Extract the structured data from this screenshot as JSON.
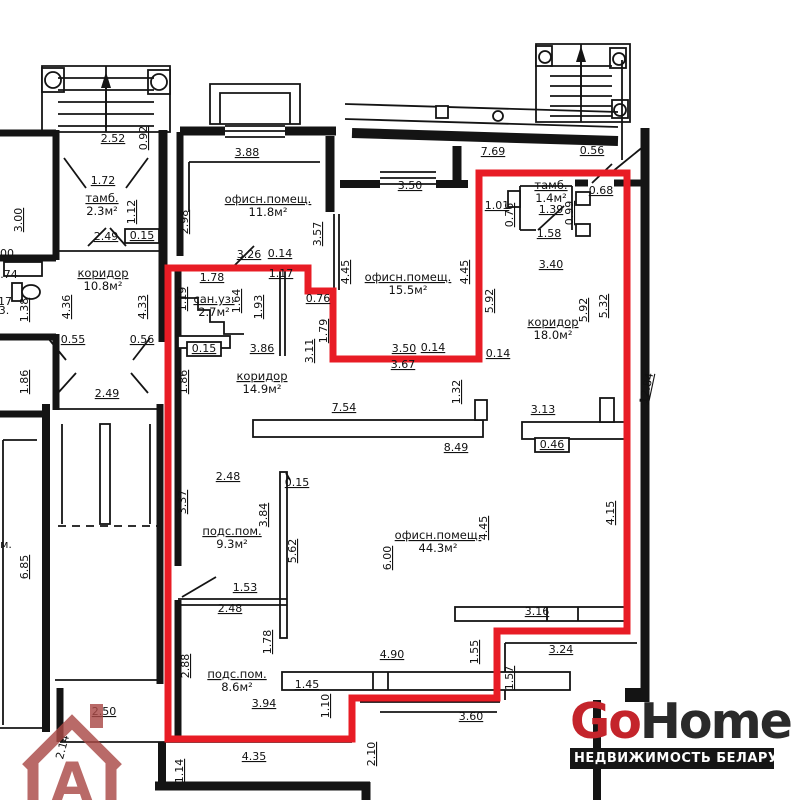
{
  "colors": {
    "outline_red": "#e81c25",
    "wall_black": "#141414",
    "watermark": "#aa4a47",
    "background": "#ffffff"
  },
  "branding": {
    "logo_go": "Go",
    "logo_home": "Home",
    "tagline": "НЕДВИЖИМОСТЬ БЕЛАРУСИ",
    "logo_red": "#c4242b",
    "logo_dark": "#2a2a2a",
    "watermark_letter": "A"
  },
  "plan": {
    "red_outline": "168,268 308,268 308,291 333,291 333,359 479,359 479,173 627,173 627,631 497,631 497,698 352,698 352,739 168,739",
    "rooms": [
      {
        "name": "тамб.",
        "area": "2.3м²",
        "x": 102,
        "y": 202
      },
      {
        "name": "офисн.помещ.",
        "area": "11.8м²",
        "x": 268,
        "y": 203
      },
      {
        "name": "коридор",
        "area": "10.8м²",
        "x": 103,
        "y": 277
      },
      {
        "name": "сан.уз.",
        "area": "2.7м²",
        "x": 214,
        "y": 303
      },
      {
        "name": "офисн.помещ.",
        "area": "15.5м²",
        "x": 408,
        "y": 281
      },
      {
        "name": "тамб.",
        "area": "1.4м²",
        "x": 551,
        "y": 189
      },
      {
        "name": "коридор",
        "area": "18.0м²",
        "x": 553,
        "y": 326
      },
      {
        "name": "коридор",
        "area": "14.9м²",
        "x": 262,
        "y": 380
      },
      {
        "name": "подс.пом.",
        "area": "9.3м²",
        "x": 232,
        "y": 535
      },
      {
        "name": "офисн.помещ.",
        "area": "44.3м²",
        "x": 438,
        "y": 539
      },
      {
        "name": "подс.пом.",
        "area": "8.6м²",
        "x": 237,
        "y": 678
      }
    ],
    "dimensions": [
      {
        "t": "2.52",
        "x": 113,
        "y": 142
      },
      {
        "t": "0.92",
        "x": 147,
        "y": 138,
        "r": -90
      },
      {
        "t": "1.72",
        "x": 103,
        "y": 184
      },
      {
        "t": "1.12",
        "x": 135,
        "y": 212,
        "r": -90
      },
      {
        "t": "2.49",
        "x": 106,
        "y": 240
      },
      {
        "t": "0.15",
        "x": 142,
        "y": 239,
        "box": true
      },
      {
        "t": "3.00",
        "x": 22,
        "y": 220,
        "r": -90
      },
      {
        "t": "3.88",
        "x": 247,
        "y": 156
      },
      {
        "t": "2.98",
        "x": 188,
        "y": 222,
        "r": -90
      },
      {
        "t": "3.57",
        "x": 321,
        "y": 234,
        "r": -90
      },
      {
        "t": "3.26",
        "x": 249,
        "y": 258
      },
      {
        "t": "0.14",
        "x": 280,
        "y": 257
      },
      {
        "t": "1.78",
        "x": 212,
        "y": 281
      },
      {
        "t": "1.17",
        "x": 281,
        "y": 277
      },
      {
        "t": "1.19",
        "x": 186,
        "y": 299,
        "r": -90
      },
      {
        "t": "1.64",
        "x": 240,
        "y": 301,
        "r": -90
      },
      {
        "t": "1.93",
        "x": 262,
        "y": 307,
        "r": -90
      },
      {
        "t": "0.76",
        "x": 318,
        "y": 302
      },
      {
        "t": "1.79",
        "x": 327,
        "y": 331,
        "r": -90
      },
      {
        "t": "3.11",
        "x": 313,
        "y": 351,
        "r": -90
      },
      {
        "t": "0.15",
        "x": 204,
        "y": 352,
        "box": true
      },
      {
        "t": "3.86",
        "x": 262,
        "y": 352
      },
      {
        "t": "4.36",
        "x": 70,
        "y": 307,
        "r": -90
      },
      {
        "t": "4.33",
        "x": 146,
        "y": 307,
        "r": -90
      },
      {
        "t": "0.55",
        "x": 73,
        "y": 343
      },
      {
        "t": "0.56",
        "x": 142,
        "y": 343
      },
      {
        "t": "1.86",
        "x": 28,
        "y": 382,
        "r": -90
      },
      {
        "t": "1.86",
        "x": 187,
        "y": 382,
        "r": -90
      },
      {
        "t": "2.49",
        "x": 107,
        "y": 397
      },
      {
        "t": "1.38",
        "x": 28,
        "y": 310,
        "r": -90
      },
      {
        "t": "00",
        "x": 7,
        "y": 257,
        "nu": true
      },
      {
        "t": ".74",
        "x": 9,
        "y": 278,
        "nu": true
      },
      {
        "t": "17",
        "x": 5,
        "y": 305,
        "nu": true
      },
      {
        "t": "3.",
        "x": 4,
        "y": 314,
        "nu": true
      },
      {
        "t": "6.85",
        "x": 28,
        "y": 567,
        "r": -90
      },
      {
        "t": "м.",
        "x": 6,
        "y": 548,
        "nu": true
      },
      {
        "t": "7.69",
        "x": 493,
        "y": 155
      },
      {
        "t": "0.56",
        "x": 592,
        "y": 154
      },
      {
        "t": "3.50",
        "x": 410,
        "y": 189
      },
      {
        "t": "1.01",
        "x": 497,
        "y": 209
      },
      {
        "t": "0.76",
        "x": 513,
        "y": 215,
        "r": -90
      },
      {
        "t": "1.39",
        "x": 551,
        "y": 213
      },
      {
        "t": "0.99",
        "x": 573,
        "y": 213,
        "r": -90
      },
      {
        "t": "0.68",
        "x": 601,
        "y": 194
      },
      {
        "t": "1.58",
        "x": 549,
        "y": 237
      },
      {
        "t": "3.40",
        "x": 551,
        "y": 268
      },
      {
        "t": "4.45",
        "x": 349,
        "y": 272,
        "r": -90
      },
      {
        "t": "4.45",
        "x": 468,
        "y": 272,
        "r": -90
      },
      {
        "t": "5.92",
        "x": 493,
        "y": 301,
        "r": -90
      },
      {
        "t": "5.92",
        "x": 587,
        "y": 310,
        "r": -90
      },
      {
        "t": "5.32",
        "x": 607,
        "y": 306,
        "r": -90
      },
      {
        "t": "12.84",
        "x": 650,
        "y": 389,
        "r": -78
      },
      {
        "t": "3.50",
        "x": 404,
        "y": 352
      },
      {
        "t": "0.14",
        "x": 433,
        "y": 351
      },
      {
        "t": "3.67",
        "x": 403,
        "y": 368
      },
      {
        "t": "0.14",
        "x": 498,
        "y": 357
      },
      {
        "t": "1.32",
        "x": 460,
        "y": 392,
        "r": -90
      },
      {
        "t": "7.54",
        "x": 344,
        "y": 411
      },
      {
        "t": "8.49",
        "x": 456,
        "y": 451
      },
      {
        "t": "3.13",
        "x": 543,
        "y": 413
      },
      {
        "t": "0.46",
        "x": 552,
        "y": 448,
        "box": true
      },
      {
        "t": "2.48",
        "x": 228,
        "y": 480
      },
      {
        "t": "3.37",
        "x": 186,
        "y": 502,
        "r": -90
      },
      {
        "t": "0.15",
        "x": 297,
        "y": 486
      },
      {
        "t": "3.84",
        "x": 267,
        "y": 515,
        "r": -90
      },
      {
        "t": "5.62",
        "x": 296,
        "y": 551,
        "r": -90
      },
      {
        "t": "6.00",
        "x": 391,
        "y": 558,
        "r": -90
      },
      {
        "t": "1.53",
        "x": 245,
        "y": 591
      },
      {
        "t": "2.48",
        "x": 230,
        "y": 612
      },
      {
        "t": "1.78",
        "x": 271,
        "y": 642,
        "r": -90
      },
      {
        "t": "4.45",
        "x": 487,
        "y": 528,
        "r": -90
      },
      {
        "t": "4.15",
        "x": 614,
        "y": 513,
        "r": -90
      },
      {
        "t": "3.16",
        "x": 537,
        "y": 615
      },
      {
        "t": "1.55",
        "x": 478,
        "y": 652,
        "r": -90
      },
      {
        "t": "3.24",
        "x": 561,
        "y": 653
      },
      {
        "t": "1.57",
        "x": 513,
        "y": 678,
        "r": -90
      },
      {
        "t": "3.60",
        "x": 471,
        "y": 720
      },
      {
        "t": "2.88",
        "x": 189,
        "y": 666,
        "r": -90
      },
      {
        "t": "1.45",
        "x": 307,
        "y": 688
      },
      {
        "t": "3.94",
        "x": 264,
        "y": 707
      },
      {
        "t": "1.10",
        "x": 329,
        "y": 706,
        "r": -90
      },
      {
        "t": "4.90",
        "x": 392,
        "y": 658
      },
      {
        "t": "4.35",
        "x": 254,
        "y": 760
      },
      {
        "t": "1.14",
        "x": 183,
        "y": 771,
        "r": -90
      },
      {
        "t": "2.10",
        "x": 375,
        "y": 754,
        "r": -90
      },
      {
        "t": "2.50",
        "x": 104,
        "y": 715
      },
      {
        "t": "2.14",
        "x": 66,
        "y": 748,
        "r": -75,
        "nu": true
      }
    ]
  }
}
